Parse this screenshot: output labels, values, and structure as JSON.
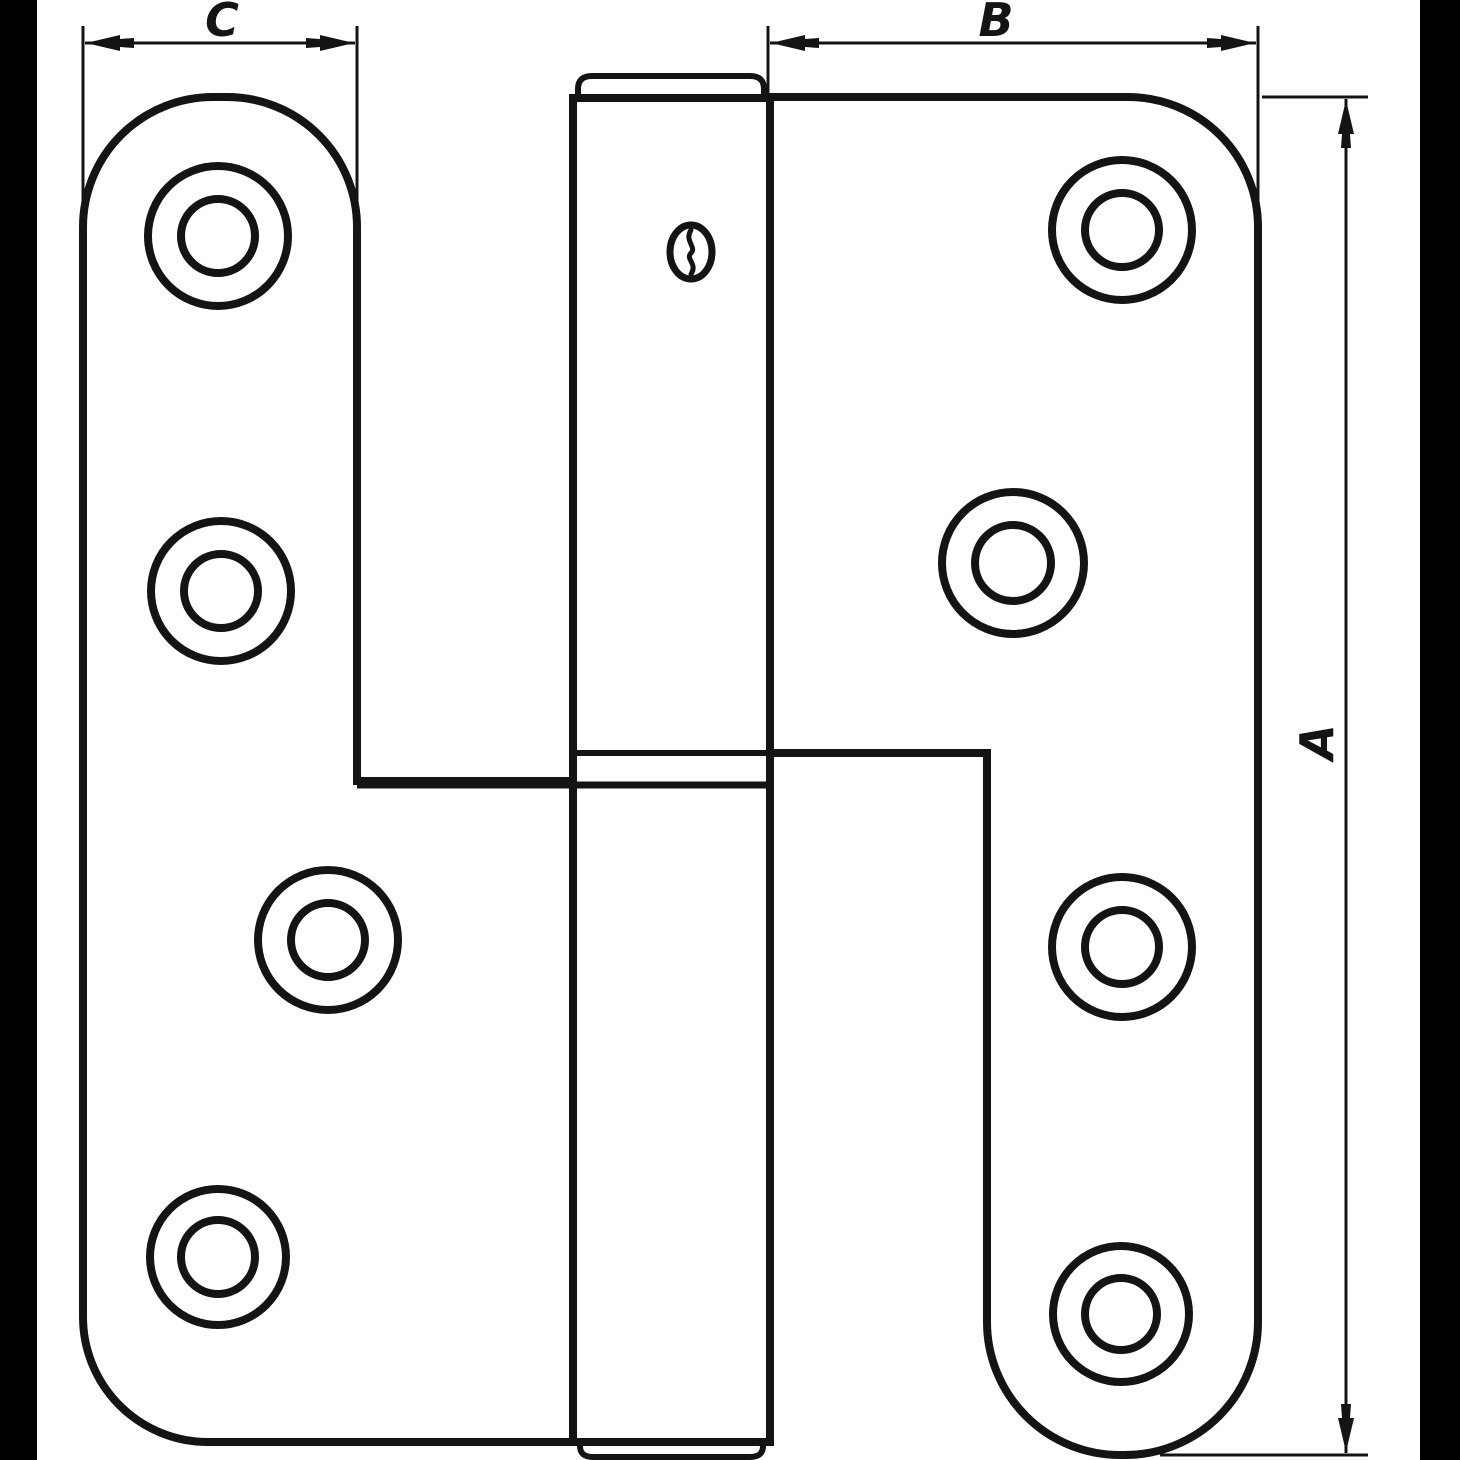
{
  "drawing": {
    "title": "lift-off door hinge technical drawing",
    "dimensions": {
      "overall_height": {
        "label": "A"
      },
      "right_leaf_width": {
        "label": "B"
      },
      "left_leaf_width": {
        "label": "C"
      }
    },
    "colors": {
      "ink": "#141414",
      "paper": "#ffffff",
      "side_bars": "#000000"
    }
  }
}
